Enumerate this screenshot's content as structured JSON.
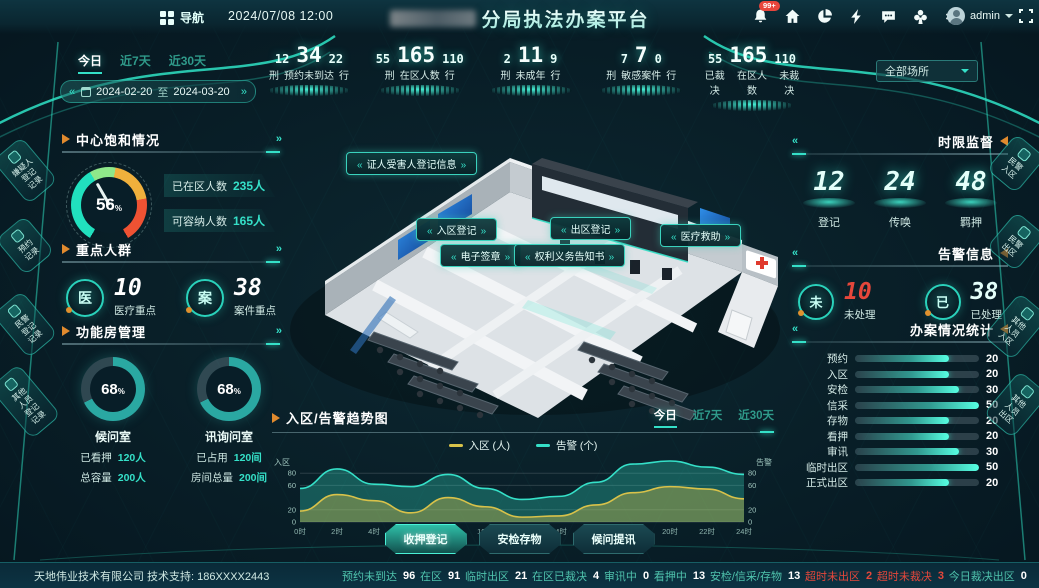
{
  "header": {
    "nav_label": "导航",
    "datetime": "2024/07/08 12:00",
    "title": "分局执法办案平台",
    "notif_badge": "99+",
    "user": "admin",
    "icons": [
      "bell-icon",
      "home-icon",
      "pie-icon",
      "bolt-icon",
      "chat-icon",
      "clover-icon",
      "gear-icon"
    ]
  },
  "filters": {
    "range_tabs": [
      "今日",
      "近7天",
      "近30天"
    ],
    "active": "今日",
    "date_from": "2024-02-20",
    "date_sep": "至",
    "date_to": "2024-03-20",
    "scope": "全部场所"
  },
  "top_stats": [
    {
      "left": "12",
      "left_label": "刑",
      "main": "34",
      "label": "预约未到达",
      "right": "22",
      "right_label": "行"
    },
    {
      "left": "55",
      "left_label": "刑",
      "main": "165",
      "label": "在区人数",
      "right": "110",
      "right_label": "行"
    },
    {
      "left": "2",
      "left_label": "刑",
      "main": "11",
      "label": "未成年",
      "right": "9",
      "right_label": "行"
    },
    {
      "left": "7",
      "left_label": "刑",
      "main": "7",
      "label": "敏感案件",
      "right": "0",
      "right_label": "行"
    },
    {
      "left": "55",
      "left_label": "已裁决",
      "main": "165",
      "label": "在区人数",
      "right": "110",
      "right_label": "未裁决"
    }
  ],
  "saturation": {
    "title": "中心饱和情况",
    "value": "56",
    "unit": "%",
    "stats": [
      {
        "label": "已在区人数",
        "value": "235",
        "suffix": "人"
      },
      {
        "label": "可容纳人数",
        "value": "165",
        "suffix": "人"
      }
    ]
  },
  "key_groups": {
    "title": "重点人群",
    "items": [
      {
        "icon": "医",
        "value": "10",
        "label": "医疗重点"
      },
      {
        "icon": "案",
        "value": "38",
        "label": "案件重点"
      }
    ]
  },
  "func_rooms": {
    "title": "功能房管理",
    "rooms": [
      {
        "percent": 68,
        "name": "候问室",
        "rows": [
          {
            "label": "已看押",
            "value": "120",
            "suffix": "人"
          },
          {
            "label": "总容量",
            "value": "200",
            "suffix": "人"
          }
        ]
      },
      {
        "percent": 68,
        "name": "讯询问室",
        "rows": [
          {
            "label": "已占用",
            "value": "120",
            "suffix": "间"
          },
          {
            "label": "房间总量",
            "value": "200",
            "suffix": "间"
          }
        ]
      }
    ]
  },
  "time_limit": {
    "title": "时限监督",
    "items": [
      {
        "value": "12",
        "label": "登记"
      },
      {
        "value": "24",
        "label": "传唤"
      },
      {
        "value": "48",
        "label": "羁押"
      }
    ]
  },
  "alerts": {
    "title": "告警信息",
    "items": [
      {
        "icon": "未",
        "value": "10",
        "label": "未处理",
        "color": "#e5473b"
      },
      {
        "icon": "已",
        "value": "38",
        "label": "已处理",
        "color": "#e4fffa"
      }
    ]
  },
  "casework": {
    "title": "办案情况统计"
  },
  "scene": {
    "labels": [
      "证人受害人登记信息",
      "入区登记",
      "出区登记",
      "电子签章",
      "权利义务告知书",
      "医疗救助"
    ]
  },
  "left_tabs": [
    "嫌疑人\n登记\n记录",
    "预约\n记录",
    "民警\n登记\n记录",
    "其他\n人员\n登记\n记录"
  ],
  "right_tabs": [
    "民警\n入区",
    "民警\n出区",
    "其他\n人员\n入区",
    "其他\n人员\n出区"
  ],
  "trend": {
    "title": "入区/告警趋势图",
    "tabs": [
      "今日",
      "近7天",
      "近30天"
    ],
    "active": "今日"
  },
  "actions": [
    "收押登记",
    "安检存物",
    "候问提讯"
  ],
  "footer": {
    "company": "天地伟业技术有限公司 技术支持: 186XXXX2443",
    "stats": [
      {
        "label": "预约未到达",
        "value": "96"
      },
      {
        "label": "在区",
        "value": "91"
      },
      {
        "label": "临时出区",
        "value": "21"
      },
      {
        "label": "在区已裁决",
        "value": "4"
      },
      {
        "label": "审讯中",
        "value": "0"
      },
      {
        "label": "看押中",
        "value": "13"
      },
      {
        "label": "安检/信采/存物",
        "value": "13"
      },
      {
        "label": "超时未出区",
        "value": "2",
        "alert": true
      },
      {
        "label": "超时未裁决",
        "value": "3",
        "alert": true
      },
      {
        "label": "今日裁决出区",
        "value": "0"
      }
    ]
  },
  "chart_data": [
    {
      "type": "area",
      "title": "入区/告警趋势图",
      "x": [
        "0时",
        "2时",
        "4时",
        "6时",
        "8时",
        "10时",
        "12时",
        "14时",
        "16时",
        "18时",
        "20时",
        "22时",
        "24时"
      ],
      "series": [
        {
          "name": "入区 (人)",
          "color": "#d8c24a",
          "values": [
            18,
            45,
            35,
            15,
            40,
            25,
            8,
            10,
            28,
            48,
            58,
            54,
            38
          ]
        },
        {
          "name": "告警 (个)",
          "color": "#35e0c8",
          "values": [
            55,
            87,
            62,
            58,
            78,
            55,
            37,
            42,
            65,
            95,
            100,
            90,
            78
          ]
        }
      ],
      "ylim": [
        0,
        100
      ],
      "yticks": [
        0,
        20,
        60,
        80
      ],
      "ylabel_left": "入区",
      "ylabel_right": "告警",
      "legend_position": "top",
      "grid": true
    },
    {
      "type": "bar",
      "title": "办案情况统计",
      "categories": [
        "预约",
        "入区",
        "安检",
        "信采",
        "存物",
        "看押",
        "审讯",
        "临时出区",
        "正式出区"
      ],
      "values": [
        20,
        20,
        30,
        50,
        20,
        20,
        30,
        50,
        20
      ],
      "xlim": [
        0,
        50
      ]
    },
    {
      "type": "gauge",
      "title": "中心饱和情况",
      "value": 56,
      "max": 100
    },
    {
      "type": "donut",
      "title": "功能房管理",
      "categories": [
        "候问室",
        "讯询问室"
      ],
      "values": [
        68,
        68
      ]
    }
  ]
}
